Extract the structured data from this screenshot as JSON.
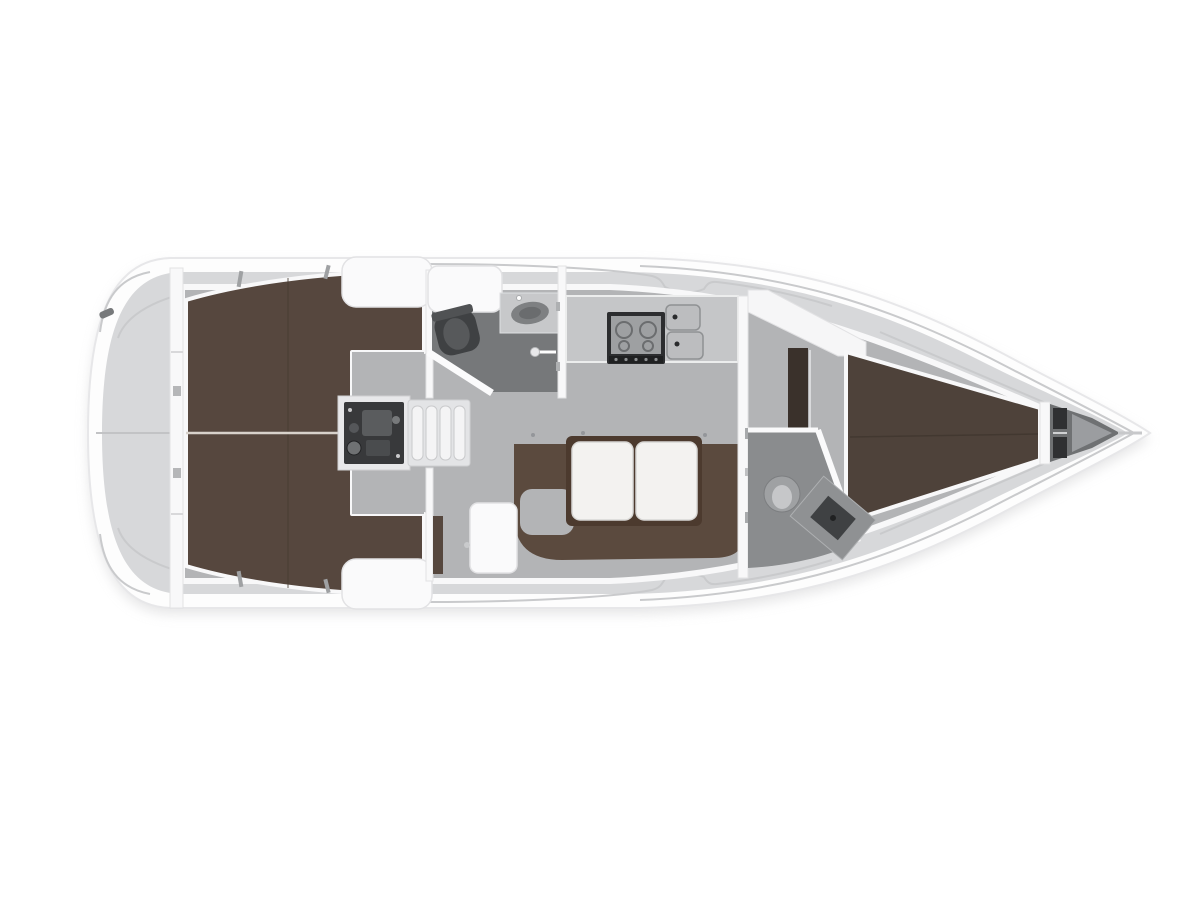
{
  "meta": {
    "title": "Sailing yacht interior layout plan — top view, bow to the right",
    "type": "boat-floor-plan",
    "view": "top-down",
    "orientation": "bow-right"
  },
  "colors": {
    "pageBg": "#ffffff",
    "hull": "#fdfdfd",
    "hullStroke": "#e7e7e9",
    "shadow": "#cdcdcf",
    "deck": "#d7d8da",
    "deckLine": "#c9cacc",
    "floor": "#b3b4b6",
    "wall": "#f8f8f9",
    "wallEdge": "#e2e2e4",
    "benchWhite": "#fafafb",
    "berthAft": "#56473e",
    "berthFwd": "#4e423a",
    "berthSeamLight": "#d8d2cb",
    "settee": "#5b4a3e",
    "tableWood": "#4c3a2e",
    "tableLeaf": "#f3f2f0",
    "headFloorAft": "#76787a",
    "headFloorFwd": "#8a8c8e",
    "fixtureDark": "#3f4143",
    "fixtureMid": "#9fa1a3",
    "engineBox": "#38393b",
    "stoveFrame": "#2c2d2f",
    "sinkSteel": "#bcbdbf",
    "anchorDark": "#2f3032",
    "lockerBrown": "#3a312b"
  },
  "features": [
    {
      "name": "swim-platform",
      "zone": "stern"
    },
    {
      "name": "stern-cleat-icon",
      "zone": "stern"
    },
    {
      "name": "aft-cabin-berth-starboard",
      "zone": "aft"
    },
    {
      "name": "aft-cabin-berth-port",
      "zone": "aft"
    },
    {
      "name": "engine-compartment",
      "zone": "aft-center"
    },
    {
      "name": "companionway-steps",
      "zone": "aft-center"
    },
    {
      "name": "cockpit-locker-starboard",
      "zone": "aft"
    },
    {
      "name": "cockpit-locker-port",
      "zone": "aft"
    },
    {
      "name": "aft-head-toilet",
      "zone": "aft-head"
    },
    {
      "name": "aft-head-sink",
      "zone": "aft-head"
    },
    {
      "name": "shower-handle-icon",
      "zone": "aft-head"
    },
    {
      "name": "galley-stove",
      "zone": "galley"
    },
    {
      "name": "galley-double-sink",
      "zone": "galley"
    },
    {
      "name": "salon-u-settee",
      "zone": "salon"
    },
    {
      "name": "salon-table-folding-leaves",
      "zone": "salon"
    },
    {
      "name": "salon-side-seat",
      "zone": "salon"
    },
    {
      "name": "forward-cabin-door",
      "zone": "forward"
    },
    {
      "name": "wardrobe-locker",
      "zone": "forward-cabin"
    },
    {
      "name": "v-berth",
      "zone": "forward-cabin"
    },
    {
      "name": "forward-head-toilet",
      "zone": "forward-head"
    },
    {
      "name": "forward-head-vanity",
      "zone": "forward-head"
    },
    {
      "name": "anchor-locker",
      "zone": "bow"
    }
  ]
}
